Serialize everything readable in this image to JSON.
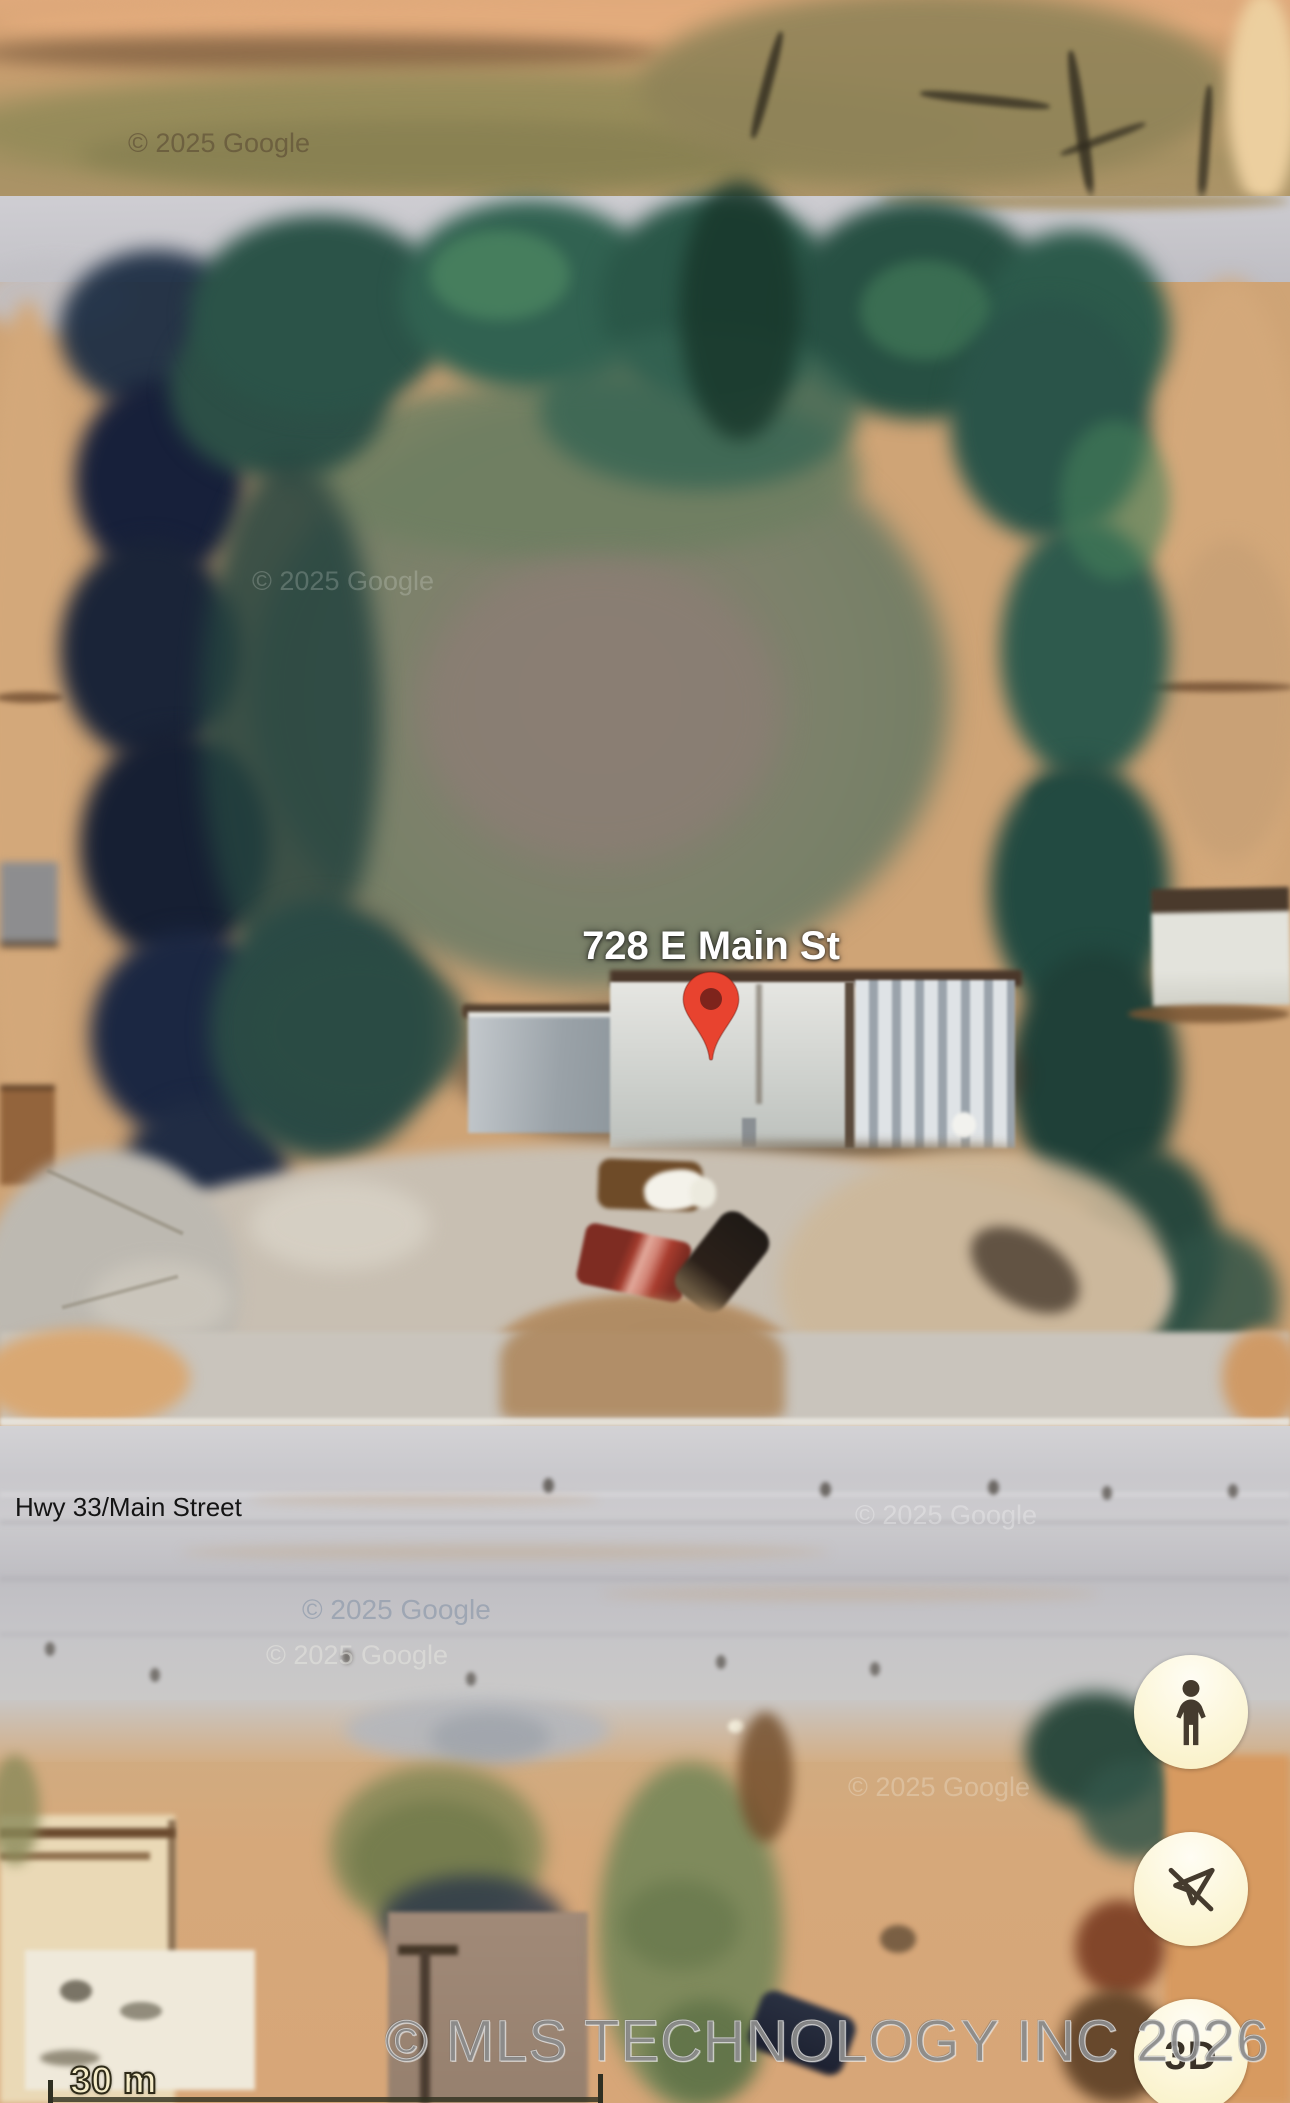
{
  "map": {
    "address_pin_label": "728 E Main St",
    "road_label": "Hwy 33/Main Street"
  },
  "watermarks": {
    "google": "© 2025 Google",
    "mls": "© MLS TECHNOLOGY INC 2026"
  },
  "scale_bar": {
    "label": "30 m"
  },
  "controls": [
    {
      "name": "street-view",
      "icon": "pegman-icon"
    },
    {
      "name": "compass-off",
      "icon": "compass-off-icon"
    },
    {
      "name": "3d-toggle",
      "label": "3D"
    }
  ],
  "colors": {
    "pin_red": "#e8432f",
    "pin_core": "#7e241c",
    "control_icon": "#453b2e"
  }
}
